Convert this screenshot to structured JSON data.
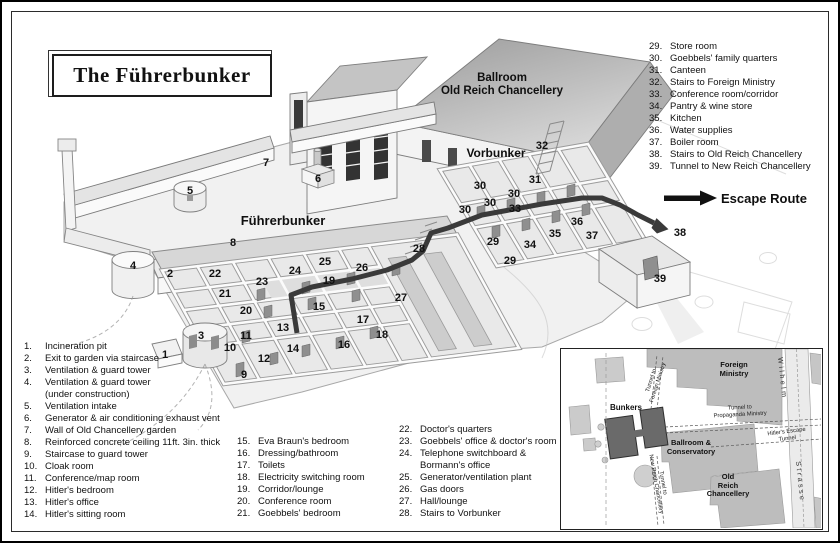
{
  "title": "The Führerbunker",
  "colors": {
    "escape_route": "#3a3a3a",
    "bunker_block": "#6a6a6a",
    "building_gray": "#bdbdbd",
    "floor_gray": "#e9e9e9"
  },
  "diagram": {
    "building_labels": {
      "ballroom": "Ballroom\nOld Reich Chancellery",
      "vorbunker": "Vorbunker",
      "fuhrerbunker": "Führerbunker",
      "escape_route": "Escape Route"
    },
    "markers": [
      {
        "n": "1",
        "x": 163,
        "y": 352
      },
      {
        "n": "2",
        "x": 168,
        "y": 271
      },
      {
        "n": "3",
        "x": 199,
        "y": 333
      },
      {
        "n": "4",
        "x": 131,
        "y": 263
      },
      {
        "n": "5",
        "x": 188,
        "y": 188
      },
      {
        "n": "6",
        "x": 316,
        "y": 176
      },
      {
        "n": "7",
        "x": 264,
        "y": 160
      },
      {
        "n": "8",
        "x": 231,
        "y": 240
      },
      {
        "n": "9",
        "x": 242,
        "y": 372
      },
      {
        "n": "10",
        "x": 228,
        "y": 345
      },
      {
        "n": "11",
        "x": 244,
        "y": 333
      },
      {
        "n": "12",
        "x": 262,
        "y": 356
      },
      {
        "n": "13",
        "x": 281,
        "y": 325
      },
      {
        "n": "14",
        "x": 291,
        "y": 346
      },
      {
        "n": "15",
        "x": 317,
        "y": 304
      },
      {
        "n": "16",
        "x": 342,
        "y": 342
      },
      {
        "n": "17",
        "x": 361,
        "y": 317
      },
      {
        "n": "18",
        "x": 380,
        "y": 332
      },
      {
        "n": "19",
        "x": 327,
        "y": 278
      },
      {
        "n": "20",
        "x": 244,
        "y": 308
      },
      {
        "n": "21",
        "x": 223,
        "y": 291
      },
      {
        "n": "22",
        "x": 213,
        "y": 271
      },
      {
        "n": "23",
        "x": 260,
        "y": 279
      },
      {
        "n": "24",
        "x": 293,
        "y": 268
      },
      {
        "n": "25",
        "x": 323,
        "y": 259
      },
      {
        "n": "26",
        "x": 360,
        "y": 265
      },
      {
        "n": "27",
        "x": 399,
        "y": 295
      },
      {
        "n": "28",
        "x": 417,
        "y": 246
      },
      {
        "n": "29",
        "x": 491,
        "y": 239
      },
      {
        "n": "29",
        "x": 508,
        "y": 258
      },
      {
        "n": "30",
        "x": 478,
        "y": 183
      },
      {
        "n": "30",
        "x": 512,
        "y": 191
      },
      {
        "n": "30",
        "x": 488,
        "y": 200
      },
      {
        "n": "30",
        "x": 463,
        "y": 207
      },
      {
        "n": "31",
        "x": 533,
        "y": 177
      },
      {
        "n": "32",
        "x": 540,
        "y": 143
      },
      {
        "n": "33",
        "x": 513,
        "y": 206
      },
      {
        "n": "34",
        "x": 528,
        "y": 242
      },
      {
        "n": "35",
        "x": 553,
        "y": 231
      },
      {
        "n": "36",
        "x": 575,
        "y": 219
      },
      {
        "n": "37",
        "x": 590,
        "y": 233
      },
      {
        "n": "38",
        "x": 678,
        "y": 230
      },
      {
        "n": "39",
        "x": 658,
        "y": 276
      }
    ]
  },
  "legend": {
    "columns": [
      {
        "items": [
          {
            "num": "1.",
            "label": "Incineration pit"
          },
          {
            "num": "2.",
            "label": "Exit to garden via staircase"
          },
          {
            "num": "3.",
            "label": "Ventilation & guard tower"
          },
          {
            "num": "4.",
            "label": "Ventilation & guard tower\n(under construction)"
          },
          {
            "num": "5.",
            "label": "Ventilation intake"
          },
          {
            "num": "6.",
            "label": "Generator & air conditioning exhaust vent"
          },
          {
            "num": "7.",
            "label": "Wall of Old Chancellery garden"
          },
          {
            "num": "8.",
            "label": "Reinforced concrete ceiling 11ft. 3in. thick"
          },
          {
            "num": "9.",
            "label": "Staircase to guard tower"
          },
          {
            "num": "10.",
            "label": "Cloak room"
          },
          {
            "num": "11.",
            "label": "Conference/map room"
          },
          {
            "num": "12.",
            "label": "Hitler's bedroom"
          },
          {
            "num": "13.",
            "label": "Hitler's office"
          },
          {
            "num": "14.",
            "label": "Hitler's sitting room"
          }
        ]
      },
      {
        "items": [
          {
            "num": "15.",
            "label": "Eva Braun's bedroom"
          },
          {
            "num": "16.",
            "label": "Dressing/bathroom"
          },
          {
            "num": "17.",
            "label": "Toilets"
          },
          {
            "num": "18.",
            "label": "Electricity switching room"
          },
          {
            "num": "19.",
            "label": "Corridor/lounge"
          },
          {
            "num": "20.",
            "label": "Conference room"
          },
          {
            "num": "21.",
            "label": "Goebbels' bedroom"
          }
        ]
      },
      {
        "items": [
          {
            "num": "22.",
            "label": "Doctor's quarters"
          },
          {
            "num": "23.",
            "label": "Goebbels' office & doctor's room"
          },
          {
            "num": "24.",
            "label": "Telephone switchboard &\nBormann's office"
          },
          {
            "num": "25.",
            "label": "Generator/ventilation plant"
          },
          {
            "num": "26.",
            "label": "Gas doors"
          },
          {
            "num": "27.",
            "label": "Hall/lounge"
          },
          {
            "num": "28.",
            "label": "Stairs to Vorbunker"
          }
        ]
      },
      {
        "items": [
          {
            "num": "29.",
            "label": "Store room"
          },
          {
            "num": "30.",
            "label": "Goebbels' family quarters"
          },
          {
            "num": "31.",
            "label": "Canteen"
          },
          {
            "num": "32.",
            "label": "Stairs to Foreign Ministry"
          },
          {
            "num": "33.",
            "label": "Conference room/corridor"
          },
          {
            "num": "34.",
            "label": "Pantry & wine store"
          },
          {
            "num": "35.",
            "label": "Kitchen"
          },
          {
            "num": "36.",
            "label": "Water supplies"
          },
          {
            "num": "37.",
            "label": "Boiler room"
          },
          {
            "num": "38.",
            "label": "Stairs to Old Reich Chancellery"
          },
          {
            "num": "39.",
            "label": "Tunnel to New Reich Chancellery"
          }
        ]
      }
    ]
  },
  "inset": {
    "foreign_ministry": "Foreign\nMinistry",
    "wilhelm": "Wilhelm",
    "strasse": "Strasse",
    "bunkers": "Bunkers",
    "ballroom_conservatory": "Ballroom &\nConservatory",
    "old_reich_chancellery": "Old\nReich\nChancellery",
    "tunnel_foreign": "Tunnel to\nForeign Ministry",
    "tunnel_propaganda": "Tunnel to\nPropaganda Ministry",
    "tunnel_new_reich": "Tunnel to\nNew Reich Chancellery",
    "hitlers_escape": "Hitler's Escape\nTunnel"
  }
}
